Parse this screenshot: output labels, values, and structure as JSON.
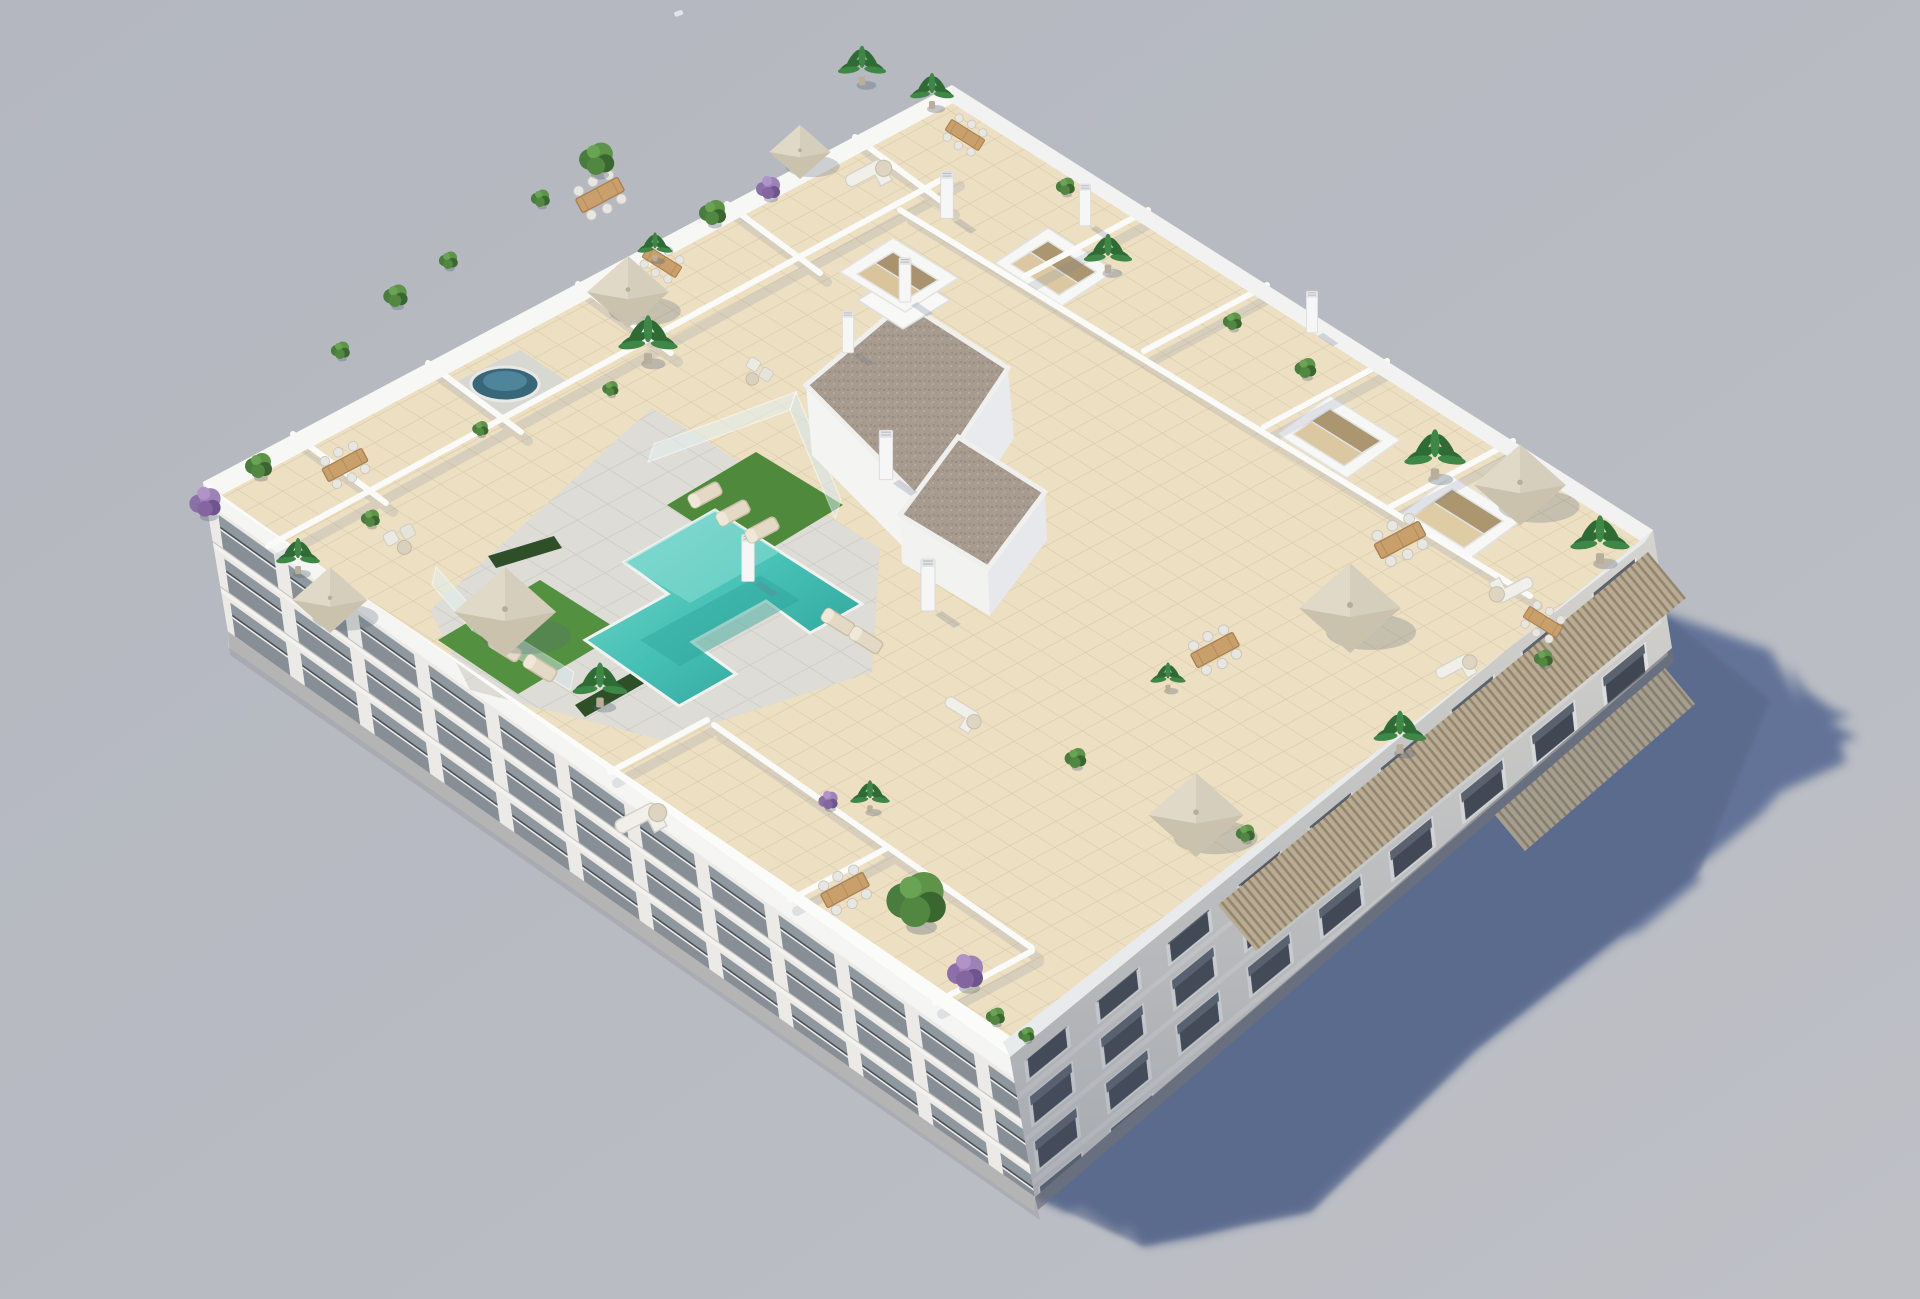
{
  "scene": {
    "type": "3d-architectural-render",
    "subject": "aerial isometric view of a white apartment block with landscaped rooftop terraces and communal pool",
    "camera": "high aerial, looking down from south-west",
    "lighting": "sunlight from upper-left casting long blue shadow to lower-right",
    "no_visible_text": true
  },
  "palette": {
    "background": "#b7bac1",
    "ground_shadow": "#5e7096",
    "roof_tile": "#ecdfc2",
    "roof_tile_line": "#d9c8a5",
    "pool_deck": "#dddcd6",
    "grass": "#4f8a3c",
    "pool_water": "#3fbdb2",
    "pool_water_deep": "#2a9a90",
    "gravel_roof": "#a79a8e",
    "walls_white": "#f6f6f6",
    "facade_sunlit": "#eceae6",
    "facade_shaded": "#dcdad4",
    "window_glass": "#42474e",
    "pergola_wood": "#cdbb97",
    "plant_green": "#4a7c3f",
    "plant_purple": "#8b6fa8",
    "umbrella_canvas": "#e6dfd0"
  },
  "inventory": {
    "floors_visible": 3,
    "rooftop_pools": 1,
    "jacuzzis": 1,
    "umbrellas": 7,
    "dining_sets": 8,
    "sofa_lounges": 5,
    "sun_loungers": 7,
    "vent_pillars": 8,
    "skylight_boxes": 4,
    "planters_and_trees": 34,
    "pergola_bands": 2,
    "distant_birds": 1
  }
}
